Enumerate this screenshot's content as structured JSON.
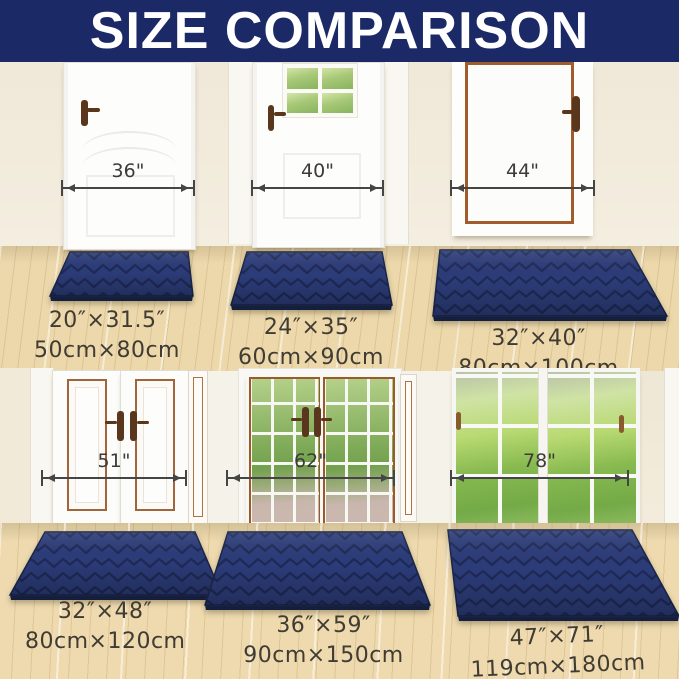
{
  "header": {
    "title": "SIZE COMPARISON"
  },
  "colors": {
    "header_bg": "#1b2a67",
    "header_text": "#ffffff",
    "mat_navy": "#2c3c79",
    "mat_pattern_line": "#1e2a57",
    "mat_edge": "#141e3d",
    "wall_cream": "#f0e8d8",
    "wall_white": "#f5f2ea",
    "floor_wood": "#ecd8ab",
    "door_trim_copper": "#a05c2c",
    "handle_brown": "#5a371c",
    "dimension_line": "#454545",
    "label_text": "#403b33"
  },
  "scenes": [
    {
      "doors": [
        {
          "width_label": "36\""
        },
        {
          "width_label": "40\""
        },
        {
          "width_label": "44\""
        }
      ],
      "mats": [
        {
          "inches": "20″×31.5″",
          "cm": "50cm×80cm"
        },
        {
          "inches": "24″×35″",
          "cm": "60cm×90cm"
        },
        {
          "inches": "32″×40″",
          "cm": "80cm×100cm"
        }
      ]
    },
    {
      "doors": [
        {
          "width_label": "51\""
        },
        {
          "width_label": "62\""
        },
        {
          "width_label": "78\""
        }
      ],
      "mats": [
        {
          "inches": "32″×48″",
          "cm": "80cm×120cm"
        },
        {
          "inches": "36″×59″",
          "cm": "90cm×150cm"
        },
        {
          "inches": "47″×71″",
          "cm": "119cm×180cm"
        }
      ]
    }
  ]
}
